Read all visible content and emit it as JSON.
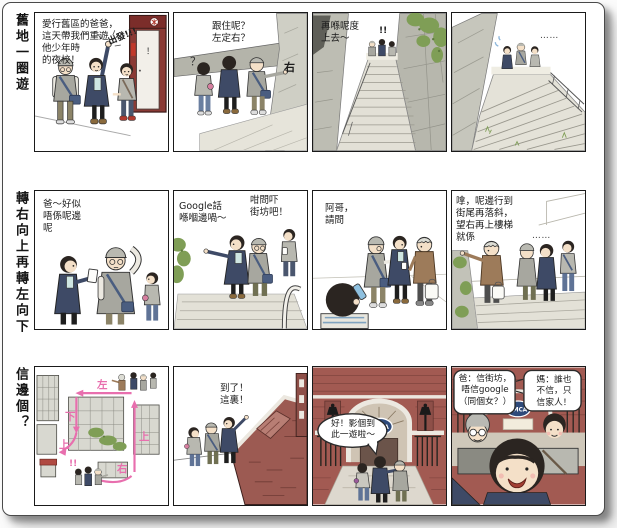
{
  "colors": {
    "route_pink": "#e86fae",
    "brick": "#a25a52",
    "door_red": "#8a3a35",
    "navy_coat": "#3e4a66",
    "foliage": "#7f9e56"
  },
  "rows": [
    {
      "label": "舊地一圈遊",
      "panels": [
        {
          "name": "setting-off",
          "caption": "愛行舊區的爸爸，\n這天帶我們重遊\n他少年時\n的夜校！",
          "sfx": "出發!!!",
          "mark": "！"
        },
        {
          "name": "which-way",
          "caption": "跟住呢？\n左定右？",
          "question": "？",
          "direction": "右"
        },
        {
          "name": "up-the-stairs",
          "caption": "再喺呢度\n上去～",
          "sfx": "!!"
        },
        {
          "name": "long-stairs",
          "dots": "⋯⋯"
        }
      ]
    },
    {
      "label": "轉右向上再轉左向下",
      "panels": [
        {
          "name": "not-this-way",
          "caption": "爸～好似\n唔係呢邊\n呢"
        },
        {
          "name": "google-says",
          "caption_left": "Google話\n喺嗰邊喎～",
          "caption_right": "咁問吓\n街坊吧！"
        },
        {
          "name": "ask-a-local",
          "caption": "阿哥，\n請問"
        },
        {
          "name": "local-directions",
          "caption": "嗱，呢邊行到\n街尾再落斜，\n望右再上樓梯\n就係",
          "dots": "⋯⋯"
        }
      ]
    },
    {
      "label": "信邊個？",
      "panels": [
        {
          "name": "route-map",
          "route_labels": [
            "左",
            "下",
            "上",
            "右",
            "上"
          ],
          "sfx": "!!"
        },
        {
          "name": "arrived",
          "caption": "到了！\n這裏！"
        },
        {
          "name": "ymca-gate",
          "bubble": "好！影個到\n此一遊啦～",
          "sign": "YMCA"
        },
        {
          "name": "family-selfie",
          "bubble_dad": "爸：信街坊，\n唔信google\n（同個女？）",
          "bubble_mom": "媽：誰也\n不信，只\n信家人！",
          "sign": "YMCA"
        }
      ]
    }
  ]
}
